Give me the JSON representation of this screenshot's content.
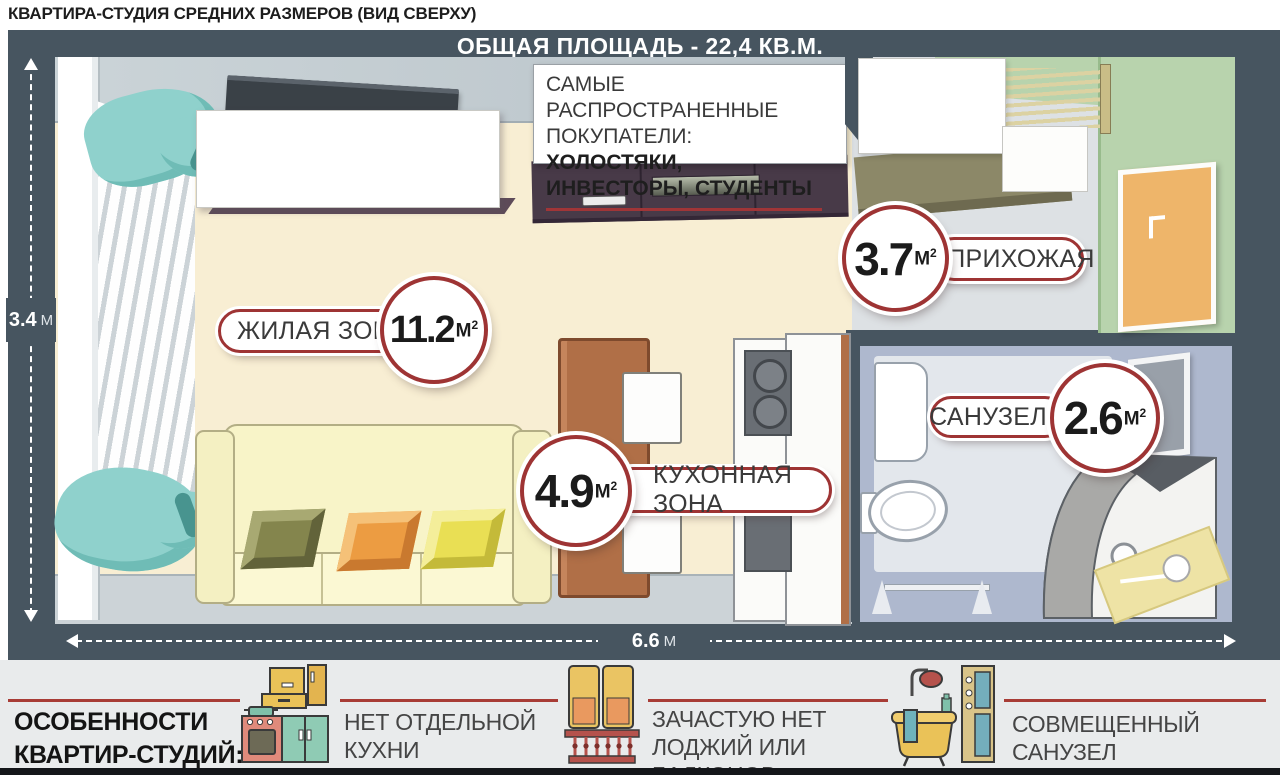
{
  "title": "КВАРТИРА-СТУДИЯ СРЕДНИХ РАЗМЕРОВ (ВИД СВЕРХУ)",
  "plan": {
    "total_area": "ОБЩАЯ ПЛОЩАДЬ - 22,4 КВ.М.",
    "buyers_note": {
      "line1": "САМЫЕ РАСПРОСТРАНЕННЫЕ",
      "line2_prefix": "ПОКУПАТЕЛИ: ",
      "line2_bold": "ХОЛОСТЯКИ,",
      "line3_bold": "ИНВЕСТОРЫ, СТУДЕНТЫ"
    },
    "dim_height_value": "3.4",
    "dim_height_unit": "М",
    "dim_width_value": "6.6",
    "dim_width_unit": "М",
    "rooms": [
      {
        "label": "ЖИЛАЯ ЗОНА",
        "area": "11.2",
        "unit_m": "М",
        "unit_exp": "2"
      },
      {
        "label": "ПРИХОЖАЯ",
        "area": "3.7",
        "unit_m": "М",
        "unit_exp": "2"
      },
      {
        "label": "САНУЗЕЛ",
        "area": "2.6",
        "unit_m": "М",
        "unit_exp": "2"
      },
      {
        "label": "КУХОННАЯ ЗОНА",
        "area": "4.9",
        "unit_m": "М",
        "unit_exp": "2"
      }
    ]
  },
  "features": {
    "title_line1": "ОСОБЕННОСТИ",
    "title_line2": "КВАРТИР-СТУДИЙ:",
    "items": [
      {
        "icon": "kitchen-icon",
        "label": "НЕТ ОТДЕЛЬНОЙ КУХНИ"
      },
      {
        "icon": "balcony-icon",
        "label": "ЗАЧАСТУЮ НЕТ ЛОДЖИЙ ИЛИ БАЛКОНОВ"
      },
      {
        "icon": "bathtub-icon",
        "label": "СОВМЕЩЕННЫЙ САНУЗЕЛ"
      }
    ]
  },
  "colors": {
    "accent_red": "#a83c36",
    "label_border_red": "#9e3434",
    "frame_slate": "#475560",
    "floor_cream": "#f8eed3",
    "hallway_floor": "#dde1e4",
    "bathroom_floor": "#aeb8ce",
    "wall_green": "#b8d3ad",
    "door_orange": "#eeb56a",
    "curtain_teal": "#8fd1cc",
    "cabinet_purple": "#483a48",
    "table_terracotta": "#b06f47"
  }
}
